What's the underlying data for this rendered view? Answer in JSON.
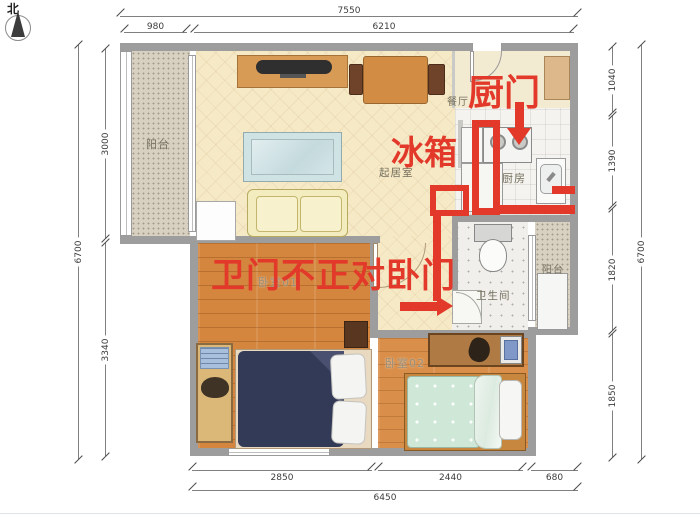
{
  "compass": {
    "north_label": "北"
  },
  "rooms": {
    "balcony_left": "阳台",
    "dining": "餐厅",
    "living": "起居室",
    "kitchen": "厨房",
    "bathroom": "卫生间",
    "balcony_right": "阳台",
    "bedroom1": "卧室01",
    "bedroom2": "卧室02"
  },
  "annotations": {
    "kitchen_door_label": "厨门",
    "fridge_label": "冰箱",
    "bath_door_note": "卫门不正对卧门",
    "accent_color": "#e2392b"
  },
  "dimensions": {
    "top_total": "7550",
    "top_left": "980",
    "top_right": "6210",
    "left_total": "6700",
    "left_upper": "3000",
    "left_lower": "3340",
    "right_total": "6700",
    "right_1": "1040",
    "right_2": "1390",
    "right_3": "1820",
    "right_4": "1850",
    "bottom_1": "2850",
    "bottom_2": "2440",
    "bottom_3": "680",
    "bottom_total": "6450"
  }
}
